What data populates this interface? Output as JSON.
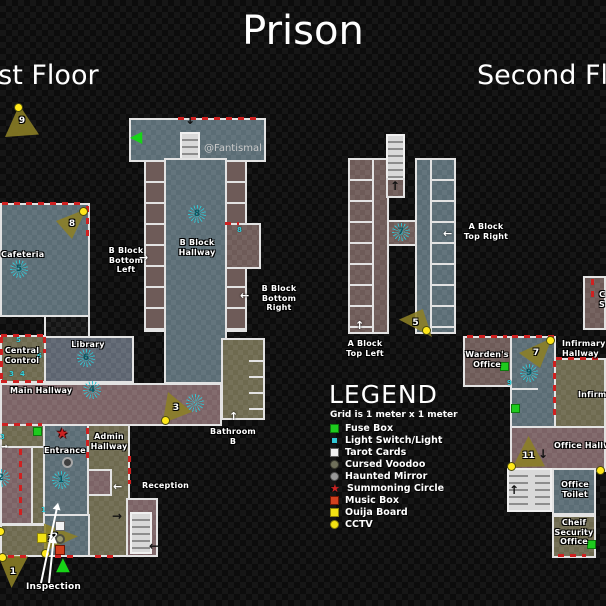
{
  "title": "Prison",
  "watermark": "@Fantismal",
  "floor_headings": {
    "first": "First Floor",
    "second": "Second Floor"
  },
  "legend": {
    "title": "LEGEND",
    "subtitle": "Grid is 1 meter x 1 meter",
    "items": [
      {
        "icon": "fuse-box-icon",
        "label": "Fuse Box",
        "color": "#1ecb1e"
      },
      {
        "icon": "light-switch-icon",
        "label": "Light Switch/Light",
        "color": "#2fc8d6"
      },
      {
        "icon": "tarot-cards-icon",
        "label": "Tarot Cards",
        "color": "#f2f2f2"
      },
      {
        "icon": "cursed-voodoo-icon",
        "label": "Cursed Voodoo",
        "color": "#6f6f5a"
      },
      {
        "icon": "haunted-mirror-icon",
        "label": "Haunted Mirror",
        "color": "#9a9a9a"
      },
      {
        "icon": "summoning-circle-icon",
        "label": "Summoning Circle",
        "color": "#cc2222"
      },
      {
        "icon": "music-box-icon",
        "label": "Music Box",
        "color": "#d2401e"
      },
      {
        "icon": "ouija-board-icon",
        "label": "Ouija Board",
        "color": "#f2e214"
      },
      {
        "icon": "cctv-icon",
        "label": "CCTV",
        "color": "#f2e214"
      }
    ]
  },
  "first_floor": {
    "rooms": {
      "cafeteria": "Cafeteria",
      "central_control": "Central Control",
      "library": "Library",
      "main_hallway": "Main Hallway",
      "entrance": "Entrance",
      "admin_hallway": "Admin Hallway",
      "reception": "Reception",
      "inspection": "Inspection",
      "bathroom": "Bathroom B",
      "b_block_hallway": "B Block Hallway",
      "b_block_bottom_left": "B Block Bottom Left",
      "b_block_bottom_right": "B Block Bottom Right"
    },
    "lights": {
      "cafeteria": "5",
      "library": "6",
      "main_hallway": "4",
      "b_block_hallway": "8",
      "entrance": "1",
      "holding_cell": "2",
      "main_hallway_east": ""
    },
    "switches": {
      "central_control_top": "5",
      "central_control_right": "6",
      "central_control_b1": "3",
      "central_control_b2": "4",
      "b_block_side_room": "8",
      "inspection": "1",
      "west_wall": "3"
    },
    "cameras": {
      "c1": "1",
      "c2": "2",
      "c3": "3",
      "c8": "8",
      "c9": "9"
    },
    "ouija_spot_count": "2"
  },
  "second_floor": {
    "rooms": {
      "a_block_top_left": "A Block Top Left",
      "a_block_top_right": "A Block Top Right",
      "wardens_office": "Warden's Office",
      "infirmary_hallway": "Infirmary Hallway",
      "infirmary": "Infirmary",
      "office_hallway": "Office Hallway",
      "office_toilet": "Office Toilet",
      "chief_security_office": "Cheif Security Office",
      "cutoff_room": "C S"
    },
    "lights": {
      "a_block": "7",
      "infirmary_hallway": "9"
    },
    "switches": {
      "infirmary_wall": "9"
    },
    "cameras": {
      "c5": "5",
      "c7": "7",
      "c11": "11"
    }
  },
  "icons": {
    "arrow_up": "↑",
    "arrow_down": "↓",
    "arrow_left": "←",
    "arrow_right": "→",
    "green_arrow_left": "◀",
    "green_start_triangle": "▲",
    "summoning_star": "★"
  }
}
